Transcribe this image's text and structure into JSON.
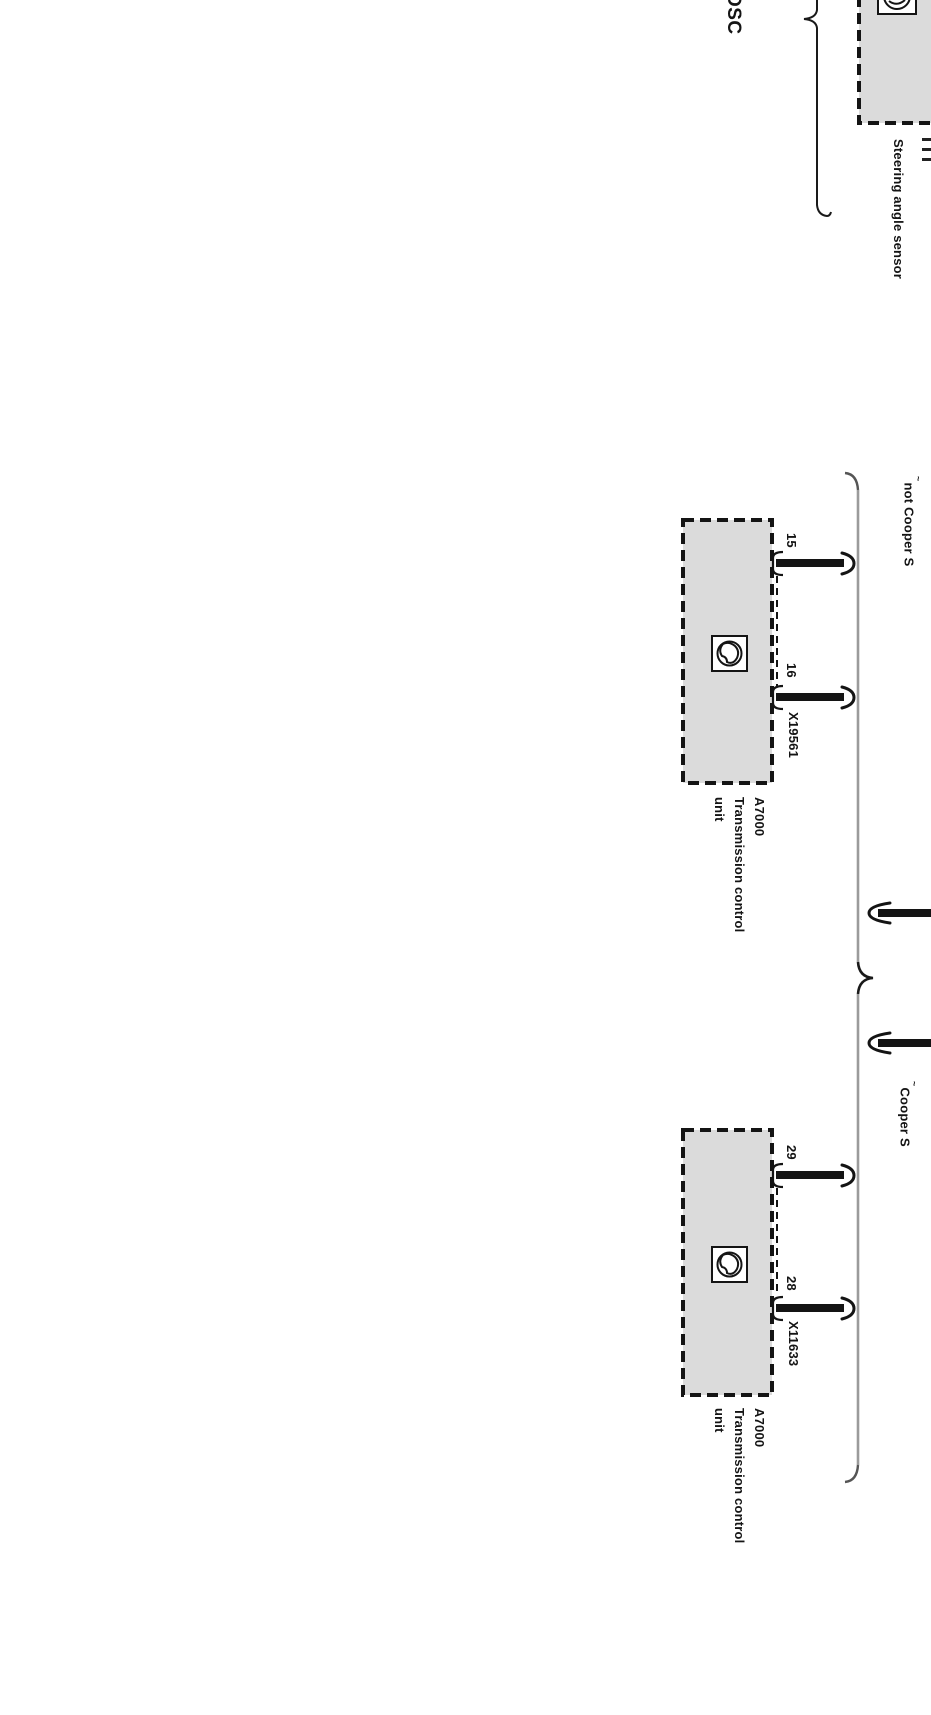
{
  "labels": {
    "dsc": "DSC",
    "steering_sensor": "Steering angle sensor",
    "footnote_mark": "~"
  },
  "top_unit": {
    "condition": "not Cooper S",
    "pin_a": "15",
    "pin_b": "16",
    "connector": "X19561",
    "id": "A7000",
    "name_line1": "Transmission control",
    "name_line2": "unit"
  },
  "bottom_unit": {
    "condition": "Cooper S",
    "pin_a": "29",
    "pin_b": "28",
    "connector": "X11633",
    "id": "A7000",
    "name_line1": "Transmission control",
    "name_line2": "unit"
  },
  "colors": {
    "box_fill": "#dbdbdb",
    "line": "#141414",
    "brace_gray": "#9b9b9b"
  }
}
